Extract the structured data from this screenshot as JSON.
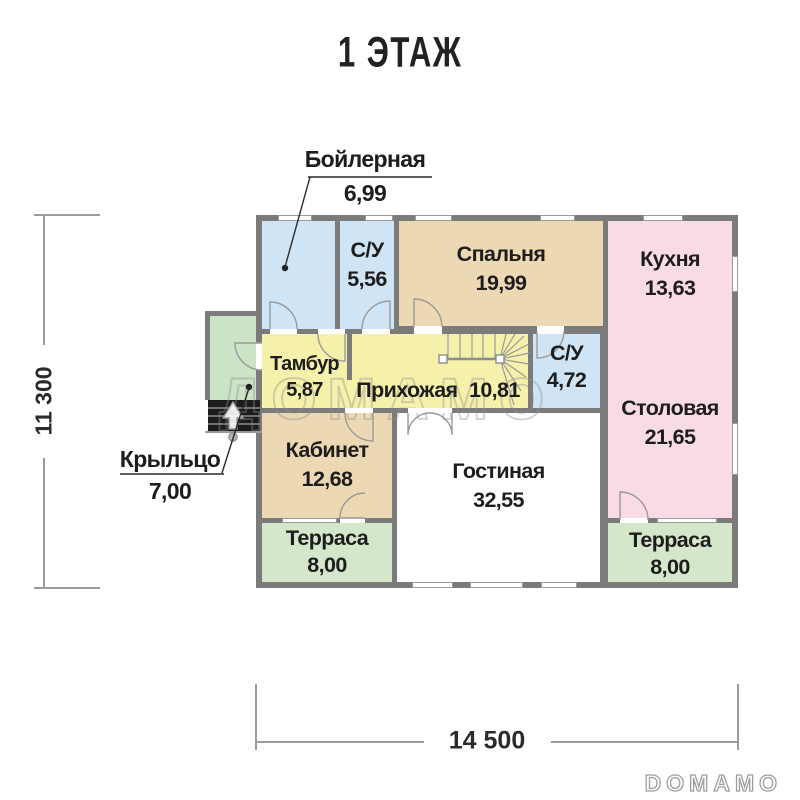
{
  "title": "1 ЭТАЖ",
  "watermark": "ДОМАМО",
  "brand_logo": "DOMAMO",
  "dimensions": {
    "total_width": "14 500",
    "total_height": "11 300"
  },
  "rooms": {
    "boilernaya": {
      "name": "Бойлерная",
      "area": "6,99"
    },
    "su_top": {
      "name": "С/У",
      "area": "5,56"
    },
    "spalnya": {
      "name": "Спальня",
      "area": "19,99"
    },
    "kuhnya": {
      "name": "Кухня",
      "area": "13,63"
    },
    "tambur": {
      "name": "Тамбур",
      "area": "5,87"
    },
    "prihozhaya": {
      "name": "Прихожая",
      "area": "10,81"
    },
    "su_mid": {
      "name": "С/У",
      "area": "4,72"
    },
    "stolovaya": {
      "name": "Столовая",
      "area": "21,65"
    },
    "kabinet": {
      "name": "Кабинет",
      "area": "12,68"
    },
    "gostinaya": {
      "name": "Гостиная",
      "area": "32,55"
    },
    "terrasa_left": {
      "name": "Терраса",
      "area": "8,00"
    },
    "terrasa_right": {
      "name": "Терраса",
      "area": "8,00"
    },
    "krylco": {
      "name": "Крыльцо",
      "area": "7,00"
    }
  },
  "colors": {
    "wall": "#7b7b7b",
    "wet_rooms_blue": "#cfe4f4",
    "living_tan": "#ecd9b3",
    "kitchen_pink": "#f8dbe6",
    "hall_yellow": "#f6f1aa",
    "terrace_green": "#d4e7ca",
    "porch_green": "#cde3c5",
    "living_white": "#ffffff"
  }
}
